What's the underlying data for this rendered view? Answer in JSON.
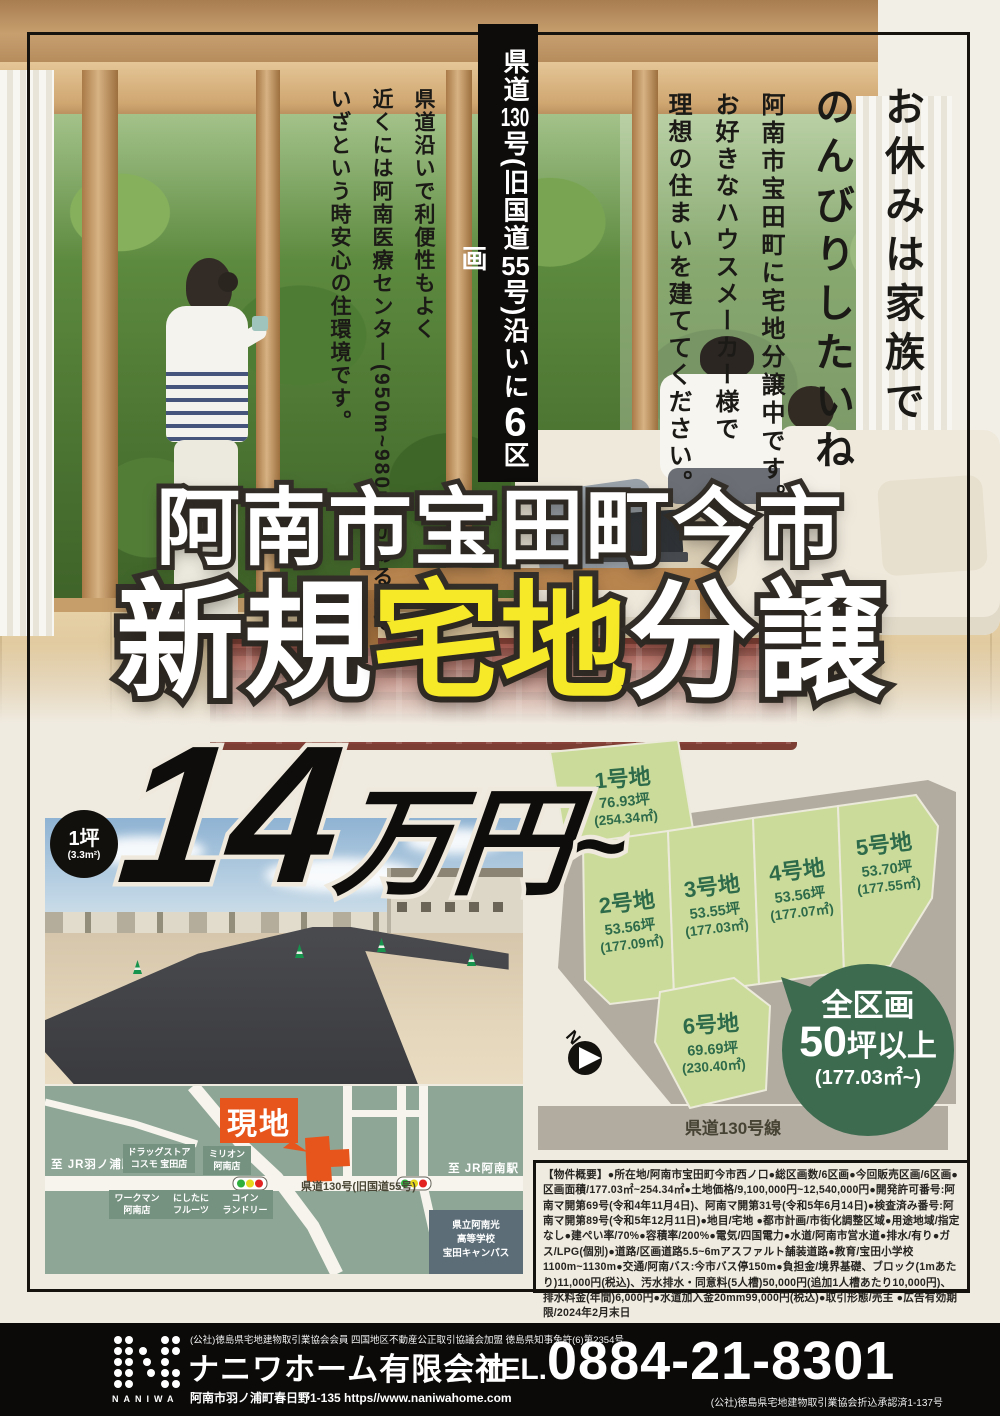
{
  "colors": {
    "cream_bg": "#f0ebe1",
    "accent_yellow": "#f6e928",
    "lot_green": "#cbdc9a",
    "lot_text_green": "#2e6b4b",
    "badge_green": "#3c6b50",
    "road_gray": "#b2aca0",
    "map_bg": "#8da695",
    "site_orange": "#e8551c",
    "school_slate": "#5c6d78",
    "footer_black": "#0b0a09"
  },
  "hero": {
    "catch_col1": "お休みは家族で",
    "catch_col2": "のんびりしたいね",
    "sub_col": "阿南市宝田町に宅地分譲中です。",
    "maker_col1": "お好きなハウスメーカー様で",
    "maker_col2": "理想の住まいを建ててください。",
    "road_badge": "県道130号(旧国道55号)沿いに6区画",
    "env_col1": "県道沿いで利便性もよく",
    "env_col2": "近くには阿南医療センター(950m~980m)があるので",
    "env_col3": "いざという時安心の住環境です。"
  },
  "title": {
    "location": "阿南市宝田町今市",
    "pre": "新規",
    "highlight": "宅地",
    "post": "分譲"
  },
  "price": {
    "unit": "1坪",
    "unit_sub": "(3.3m²)",
    "amount": "14",
    "currency": "万円",
    "from": "~"
  },
  "plan": {
    "lots": [
      {
        "name": "1号地",
        "tsubo": "76.93坪",
        "sqm": "(254.34㎡)"
      },
      {
        "name": "2号地",
        "tsubo": "53.56坪",
        "sqm": "(177.09㎡)"
      },
      {
        "name": "3号地",
        "tsubo": "53.55坪",
        "sqm": "(177.03㎡)"
      },
      {
        "name": "4号地",
        "tsubo": "53.56坪",
        "sqm": "(177.07㎡)"
      },
      {
        "name": "5号地",
        "tsubo": "53.70坪",
        "sqm": "(177.55㎡)"
      },
      {
        "name": "6号地",
        "tsubo": "69.69坪",
        "sqm": "(230.40㎡)"
      }
    ],
    "badge_line1": "全区画",
    "badge_num": "50",
    "badge_unit": "坪以上",
    "badge_line3": "(177.03㎡~)",
    "road_label": "県道130号線",
    "compass": "N"
  },
  "map": {
    "site_label": "現地",
    "station_left": "至 JR羽ノ浦駅",
    "station_right": "至 JR阿南駅",
    "road_label": "県道130号(旧国道55号)",
    "poi_drugstore": "ドラッグストア\nコスモ 宝田店",
    "poi_million": "ミリオン\n阿南店",
    "poi_workman": "ワークマン\n阿南店",
    "poi_fruits": "にしたに\nフルーツ",
    "poi_laundry": "コイン\nランドリー",
    "school": "県立阿南光\n高等学校\n宝田キャンパス"
  },
  "outline_text": "【物件概要】●所在地/阿南市宝田町今市西ノ口●総区画数/6区画●今回販売区画/6区画●区画面積/177.03㎡~254.34㎡●土地価格/9,100,000円~12,540,000円●開発許可番号:阿南マ開第69号(令和4年11月4日)、阿南マ開第31号(令和5年6月14日)●検査済み番号:阿南マ開第89号(令和5年12月11日)●地目/宅地 ●都市計画/市街化調整区域●用途地域/指定なし●建ぺい率/70%●容積率/200%●電気/四国電力●水道/阿南市営水道●排水/有り●ガス/LPG(個別)●道路/区画道路5.5~6mアスファルト舗装道路●教育/宝田小学校1100m~1130m●交通/阿南バス:今市バス停150m●負担金/境界基礎、ブロック(1mあたり)11,000円(税込)、汚水排水・同意料(5人槽)50,000円(追加1人槽あたり10,000円)、排水料金(年間)6,000円●水道加入金20mm99,000円(税込)●取引形態/売主 ●広告有効期限/2024年2月末日",
  "footer": {
    "memberships": "(公社)徳島県宅地建物取引業協会会員 四国地区不動産公正取引協議会加盟 徳島県知事免許(6)第2354号",
    "company": "ナニワホーム有限会社",
    "address": "阿南市羽ノ浦町春日野1-135 https//www.naniwahome.com",
    "tel_label": "TEL.",
    "tel": "0884-21-8301",
    "approval": "(公社)徳島県宅地建物取引業協会折込承認済1-137号",
    "logo": "NANIWA"
  }
}
